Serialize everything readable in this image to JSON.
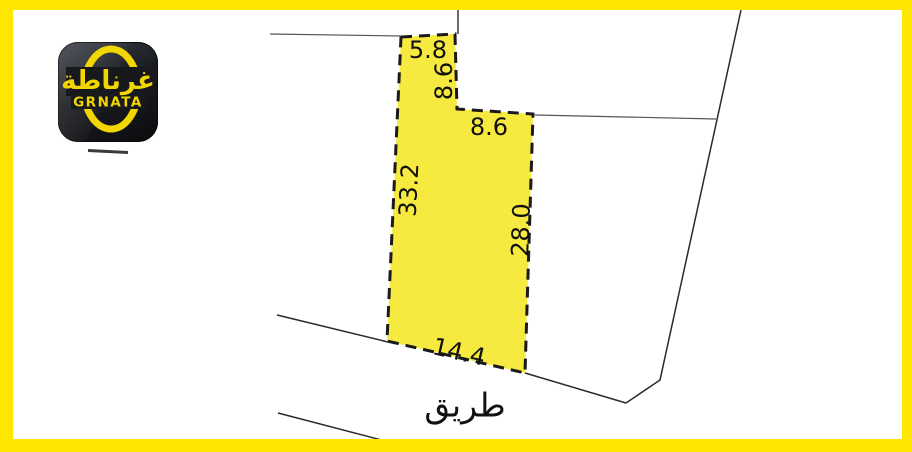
{
  "logo": {
    "arabic": "غرناطة",
    "latin": "GRNATA"
  },
  "parcel": {
    "dims": {
      "top": "5.8",
      "neck_right": "8.6",
      "step_top": "8.6",
      "left": "33.2",
      "right": "28.0",
      "bottom": "14.4"
    }
  },
  "road": {
    "label": "طريق"
  },
  "colors": {
    "frame": "#FFE600",
    "parcel_fill": "#F6E93F",
    "parcel_border": "#1a1a1a",
    "boundary_line": "#2a2a2a",
    "logo_bg": "#17191d",
    "logo_yellow": "#F1D600",
    "label_text": "#111111"
  }
}
